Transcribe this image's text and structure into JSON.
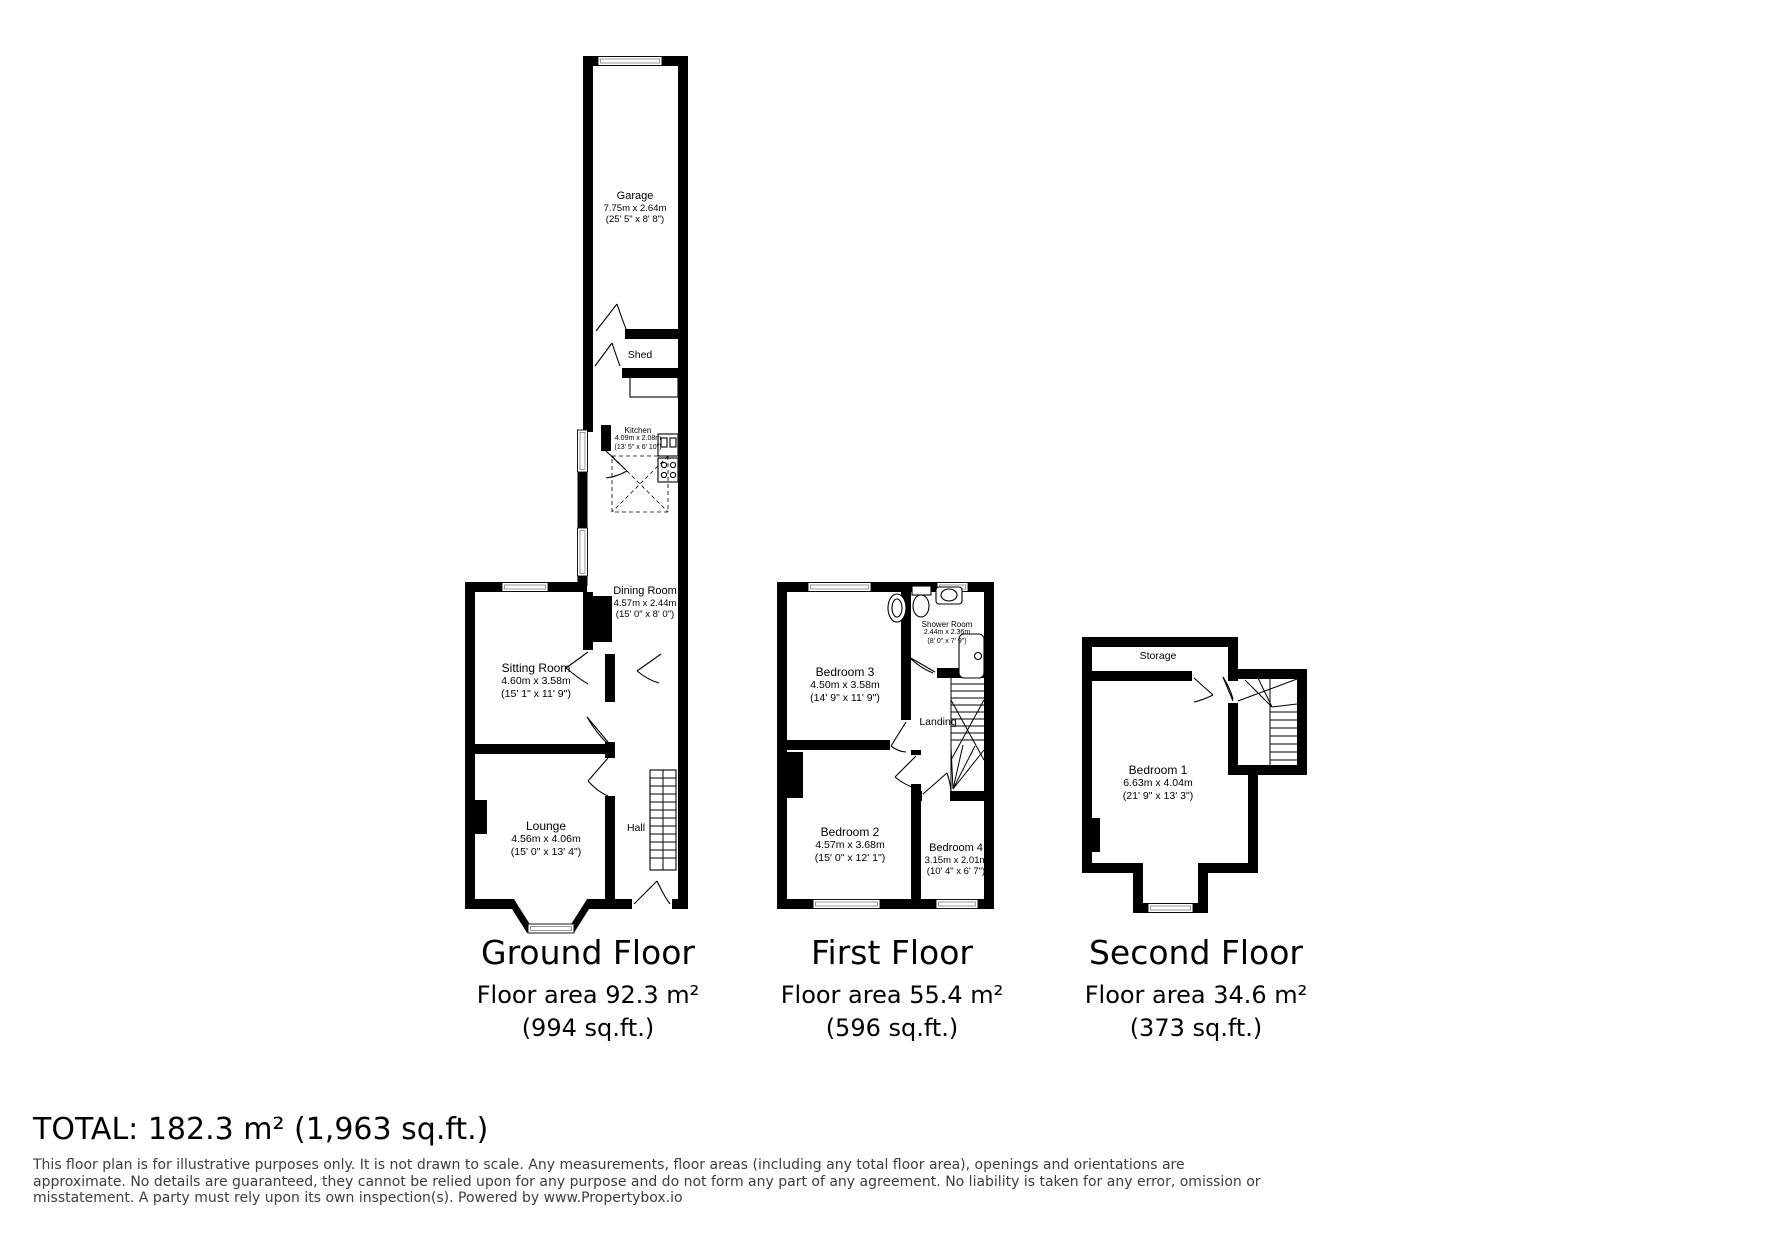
{
  "colors": {
    "wall": "#000000",
    "window_line": "#9a9a9a",
    "disclaimer_text": "#3d3d3d",
    "background": "#ffffff"
  },
  "rooms": [
    {
      "id": "garage",
      "name": "Garage",
      "dim_m": "7.75m x 2.64m",
      "dim_ft": "(25' 5\" x 8' 8\")",
      "cx": 635,
      "y": 190,
      "cls": "md"
    },
    {
      "id": "shed",
      "name": "Shed",
      "cx": 640,
      "y": 349,
      "cls": "single"
    },
    {
      "id": "kitchen",
      "name": "Kitchen",
      "dim_m": "4.09m x 2.08m",
      "dim_ft": "(13' 5\" x 6' 10\")",
      "cx": 638,
      "y": 426,
      "cls": "sm"
    },
    {
      "id": "dining-room",
      "name": "Dining Room",
      "dim_m": "4.57m x 2.44m",
      "dim_ft": "(15' 0\" x 8' 0\")",
      "cx": 645,
      "y": 585,
      "cls": "md"
    },
    {
      "id": "sitting-room",
      "name": "Sitting Room",
      "dim_m": "4.60m x 3.58m",
      "dim_ft": "(15' 1\" x 11' 9\")",
      "cx": 536,
      "y": 661,
      "cls": "lg"
    },
    {
      "id": "lounge",
      "name": "Lounge",
      "dim_m": "4.56m x 4.06m",
      "dim_ft": "(15' 0\" x 13' 4\")",
      "cx": 546,
      "y": 819,
      "cls": "lg"
    },
    {
      "id": "hall",
      "name": "Hall",
      "cx": 636,
      "y": 822,
      "cls": "single"
    },
    {
      "id": "bedroom-3",
      "name": "Bedroom 3",
      "dim_m": "4.50m x 3.58m",
      "dim_ft": "(14' 9\" x 11' 9\")",
      "cx": 845,
      "y": 665,
      "cls": "lg"
    },
    {
      "id": "shower-room",
      "name": "Shower Room",
      "dim_m": "2.44m x 2.36m",
      "dim_ft": "(8' 0\" x 7' 9\")",
      "cx": 947,
      "y": 620,
      "cls": "sm"
    },
    {
      "id": "landing",
      "name": "Landing",
      "cx": 938,
      "y": 716,
      "cls": "single"
    },
    {
      "id": "bedroom-2",
      "name": "Bedroom 2",
      "dim_m": "4.57m x 3.68m",
      "dim_ft": "(15' 0\" x 12' 1\")",
      "cx": 850,
      "y": 825,
      "cls": "lg"
    },
    {
      "id": "bedroom-4",
      "name": "Bedroom 4",
      "dim_m": "3.15m x 2.01m",
      "dim_ft": "(10' 4\" x 6' 7\")",
      "cx": 956,
      "y": 842,
      "cls": "md"
    },
    {
      "id": "storage",
      "name": "Storage",
      "cx": 1158,
      "y": 650,
      "cls": "single"
    },
    {
      "id": "bedroom-1",
      "name": "Bedroom 1",
      "dim_m": "6.63m x 4.04m",
      "dim_ft": "(21' 9\" x 13' 3\")",
      "cx": 1158,
      "y": 763,
      "cls": "lg"
    }
  ],
  "floors": [
    {
      "title": "Ground Floor",
      "area_m2": "Floor area 92.3 m²",
      "area_ft2": "(994 sq.ft.)",
      "cx": 588
    },
    {
      "title": "First Floor",
      "area_m2": "Floor area 55.4 m²",
      "area_ft2": "(596 sq.ft.)",
      "cx": 892
    },
    {
      "title": "Second Floor",
      "area_m2": "Floor area 34.6 m²",
      "area_ft2": "(373 sq.ft.)",
      "cx": 1196
    }
  ],
  "total": "TOTAL: 182.3 m² (1,963 sq.ft.)",
  "disclaimer": [
    "This floor plan is for illustrative purposes only. It is not drawn to scale. Any measurements, floor areas (including any total floor area), openings and orientations are",
    "approximate. No details are guaranteed, they cannot be relied upon for any purpose and do not form any part of any agreement. No liability is taken for any error, omission or",
    "misstatement. A party must rely upon its own inspection(s). Powered by www.Propertybox.io"
  ]
}
